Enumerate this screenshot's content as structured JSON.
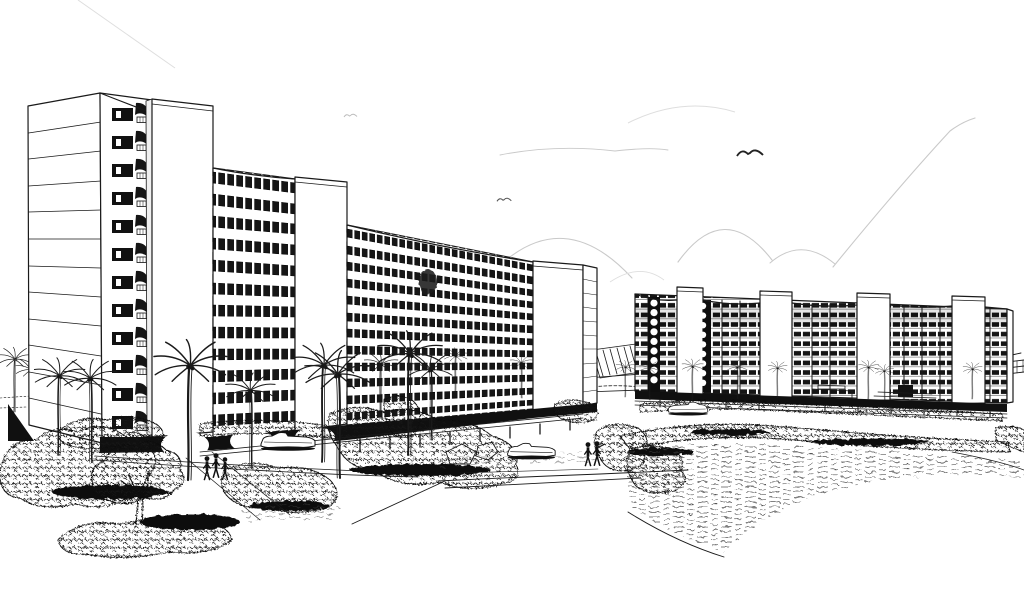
{
  "meta": {
    "title": "Architectural perspective sketch of a curved seaside high-rise complex",
    "medium": "pen-and-ink line drawing on white paper",
    "palette": {
      "paper": "#ffffff",
      "ink": "#1a1a1a",
      "pencil": "#c9c9c9",
      "shadow": "#101010"
    }
  },
  "scene": {
    "description": "Black-and-white architectural perspective drawing: two long curved apartment slabs raised on pilotis sweep across the page, each with rooftop elevator cores and stacked scalloped balconies; palm trees, scribbled shrub banks, lawns and footpaths fill the foreground with three cars and small groups of pedestrians; faint pencil cloud arcs and seagulls mark the sky.",
    "sky": {
      "clouds": "faint pencil arcs",
      "birds": 3
    },
    "buildings": {
      "left_wing": {
        "floors": 12,
        "rooftop_cores": 3,
        "features": [
          "curved slab",
          "scalloped balconies",
          "open pilotis ground floor",
          "end gable wall"
        ]
      },
      "right_wing": {
        "floors": 10,
        "rooftop_cores": 4,
        "features": [
          "curved slab",
          "window-grid facade",
          "entrance steps",
          "open pilotis ground floor"
        ]
      },
      "gap_feature": "distant hatched shade structure between the wings"
    },
    "landscape": {
      "palm_trees": 21,
      "shrub_clusters": 12,
      "lawns": 2,
      "deciduous_trees": 1,
      "paths": [
        "central access road",
        "curved footpath",
        "walkway by pedestrians"
      ]
    },
    "vehicles": {
      "cars": 3
    },
    "people": {
      "groups": [
        {
          "count": 3,
          "location": "left walkway"
        },
        {
          "count": 2,
          "location": "central road edge"
        }
      ]
    }
  }
}
